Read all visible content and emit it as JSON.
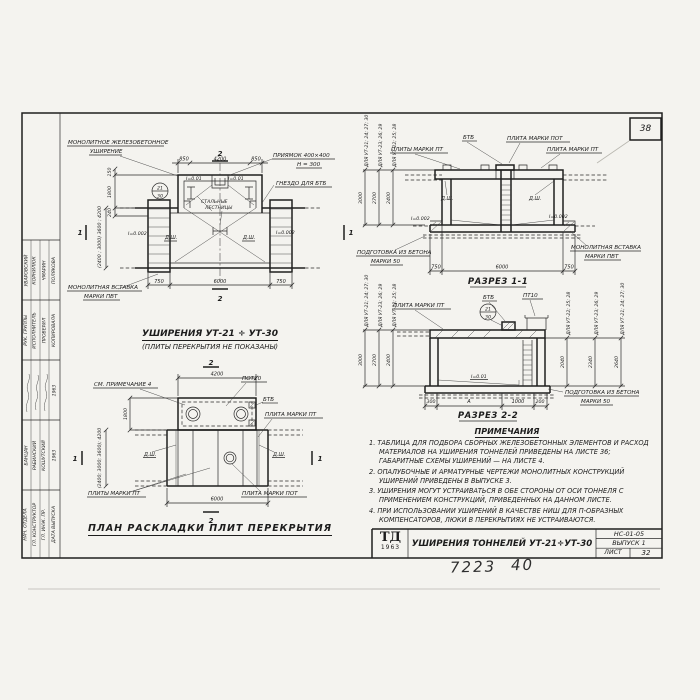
{
  "sheet": {
    "corner_number": "38",
    "handwritten_left": "7223",
    "handwritten_right": "40"
  },
  "stamp": {
    "row1_names": [
      "Уваровский",
      "Корнилюк",
      "Чмарин",
      "Полякова"
    ],
    "row1_roles": [
      "Рук. группы",
      "Исполнитель",
      "Проверил",
      "Копировала"
    ],
    "year": "1963",
    "row2_names": [
      "Банцан",
      "Рабинский",
      "Кошутский",
      "1963"
    ],
    "row2_roles": [
      "Нач. отдела",
      "Гл. конструктор",
      "Гл. инж. пр.",
      "Дата выпуска"
    ]
  },
  "plan_top": {
    "title": "Уширения УТ-21 ÷ УТ-30",
    "subtitle": "(Плиты перекрытия не показаны)",
    "callout_widening_1": "Монолитное железобетонное",
    "callout_widening_2": "уширение",
    "callout_pit_1": "Приямок 400×400",
    "callout_pit_2": "h = 300",
    "callout_socket": "Гнездо для БТб",
    "callout_ladder_1": "Стальные",
    "callout_ladder_2": "лестницы",
    "callout_insert_1": "Монолитная вставка",
    "callout_insert_2": "марки ПВТ",
    "slope_small_1": "i=0.01",
    "slope_small_2": "i=0.01",
    "slope_left": "i=0.002",
    "slope_right": "i=0.002",
    "joint_left": "Д.ш.",
    "joint_right": "Д.ш.",
    "mark_num": "21",
    "mark_den": "30",
    "dim_top": [
      "850",
      "4200",
      "850"
    ],
    "dim_bottom": [
      "750",
      "6000",
      "750"
    ],
    "dim_left": [
      "150",
      "1800",
      "240"
    ],
    "dim_left_range": "(2400 ; 3000) 3600 ; 4200",
    "sec2": "2",
    "sec1": "1"
  },
  "section1": {
    "title": "Разрез 1-1",
    "callout_bt6": "БТб",
    "callout_pot": "Плита марки ПОТ",
    "callout_pts": "Плиты марки ПТ",
    "callout_pt": "Плита марки ПТ",
    "callout_prep_1": "Подготовка из бетона",
    "callout_prep_2": "марки 50",
    "callout_insert_1": "Монолитная вставка",
    "callout_insert_2": "марки ПВТ",
    "joint_left": "Д.ш.",
    "joint_right": "Д.ш.",
    "slope_left": "i=0.002",
    "slope_right": "i=0.002",
    "left_dims": [
      {
        "label": "Для УТ-21; 24; 27; 30",
        "value": "3000"
      },
      {
        "label": "Для УТ-23; 26; 29",
        "value": "2700"
      },
      {
        "label": "Для УТ-22; 25; 28",
        "value": "2400"
      }
    ],
    "dim_bottom": [
      "750",
      "6000",
      "750"
    ]
  },
  "section2": {
    "title": "Разрез 2-2",
    "callout_pt": "Плита марки ПТ",
    "callout_bt6": "БТб",
    "callout_pt10": "ПТ10",
    "callout_prep_1": "Подготовка из бетона",
    "callout_prep_2": "марки 50",
    "slope": "i=0.01",
    "mark_num": "21",
    "mark_den": "30",
    "left_dims": [
      {
        "label": "Для УТ-21; 24; 27; 30",
        "value": "3000"
      },
      {
        "label": "Для УТ-23; 26; 29",
        "value": "2700"
      },
      {
        "label": "Для УТ-22; 25; 28",
        "value": "2400"
      }
    ],
    "right_dims": [
      {
        "label": "Для УТ-22; 25; 28",
        "value": "2040"
      },
      {
        "label": "Для УТ-23; 26; 29",
        "value": "2340"
      },
      {
        "label": "Для УТ-21; 24; 27; 30",
        "value": "2640"
      }
    ],
    "dim_bottom": [
      "300",
      "А",
      "1000",
      "200"
    ]
  },
  "plan_bottom": {
    "title": "План раскладки плит перекрытия",
    "callout_note": "См. примечание 4",
    "callout_pot10": "ПОТ10",
    "callout_bt6": "БТб",
    "callout_pt": "Плита марки ПТ",
    "callout_pts": "Плиты марки ПТ",
    "callout_pot": "Плита марки ПОТ",
    "joint_left": "Д.ш.",
    "joint_right": "Д.ш.",
    "dim_top": "4200",
    "dim_left": "1800",
    "dim_left_range": "(2400; 3000; 3600); 4200",
    "dim_bottom": "6000",
    "sec1": "1",
    "sec2": "2"
  },
  "notes": {
    "header": "Примечания",
    "items": [
      "1. Таблица для подбора сборных железобетонных элементов и расход материалов на уширения тоннелей приведены на листе 36; габаритные схемы уширений — на листе 4.",
      "2. Опалубочные и арматурные чертежи монолитных конструкций уширений приведены в выпуске 3.",
      "3. Уширения могут устраиваться в обе стороны от оси тоннеля с применением конструкций, приведенных на данном листе.",
      "4. При использовании уширений в качестве ниш для П-образных компенсаторов, люки в перекрытиях не устраиваются."
    ]
  },
  "title_block": {
    "logo_name": "ТД",
    "logo_year": "1963",
    "title": "Уширения тоннелей УТ-21÷УТ-30",
    "doc_code": "НС-01-05",
    "issue": "Выпуск 1",
    "sheet_label": "Лист",
    "sheet_number": "32"
  }
}
